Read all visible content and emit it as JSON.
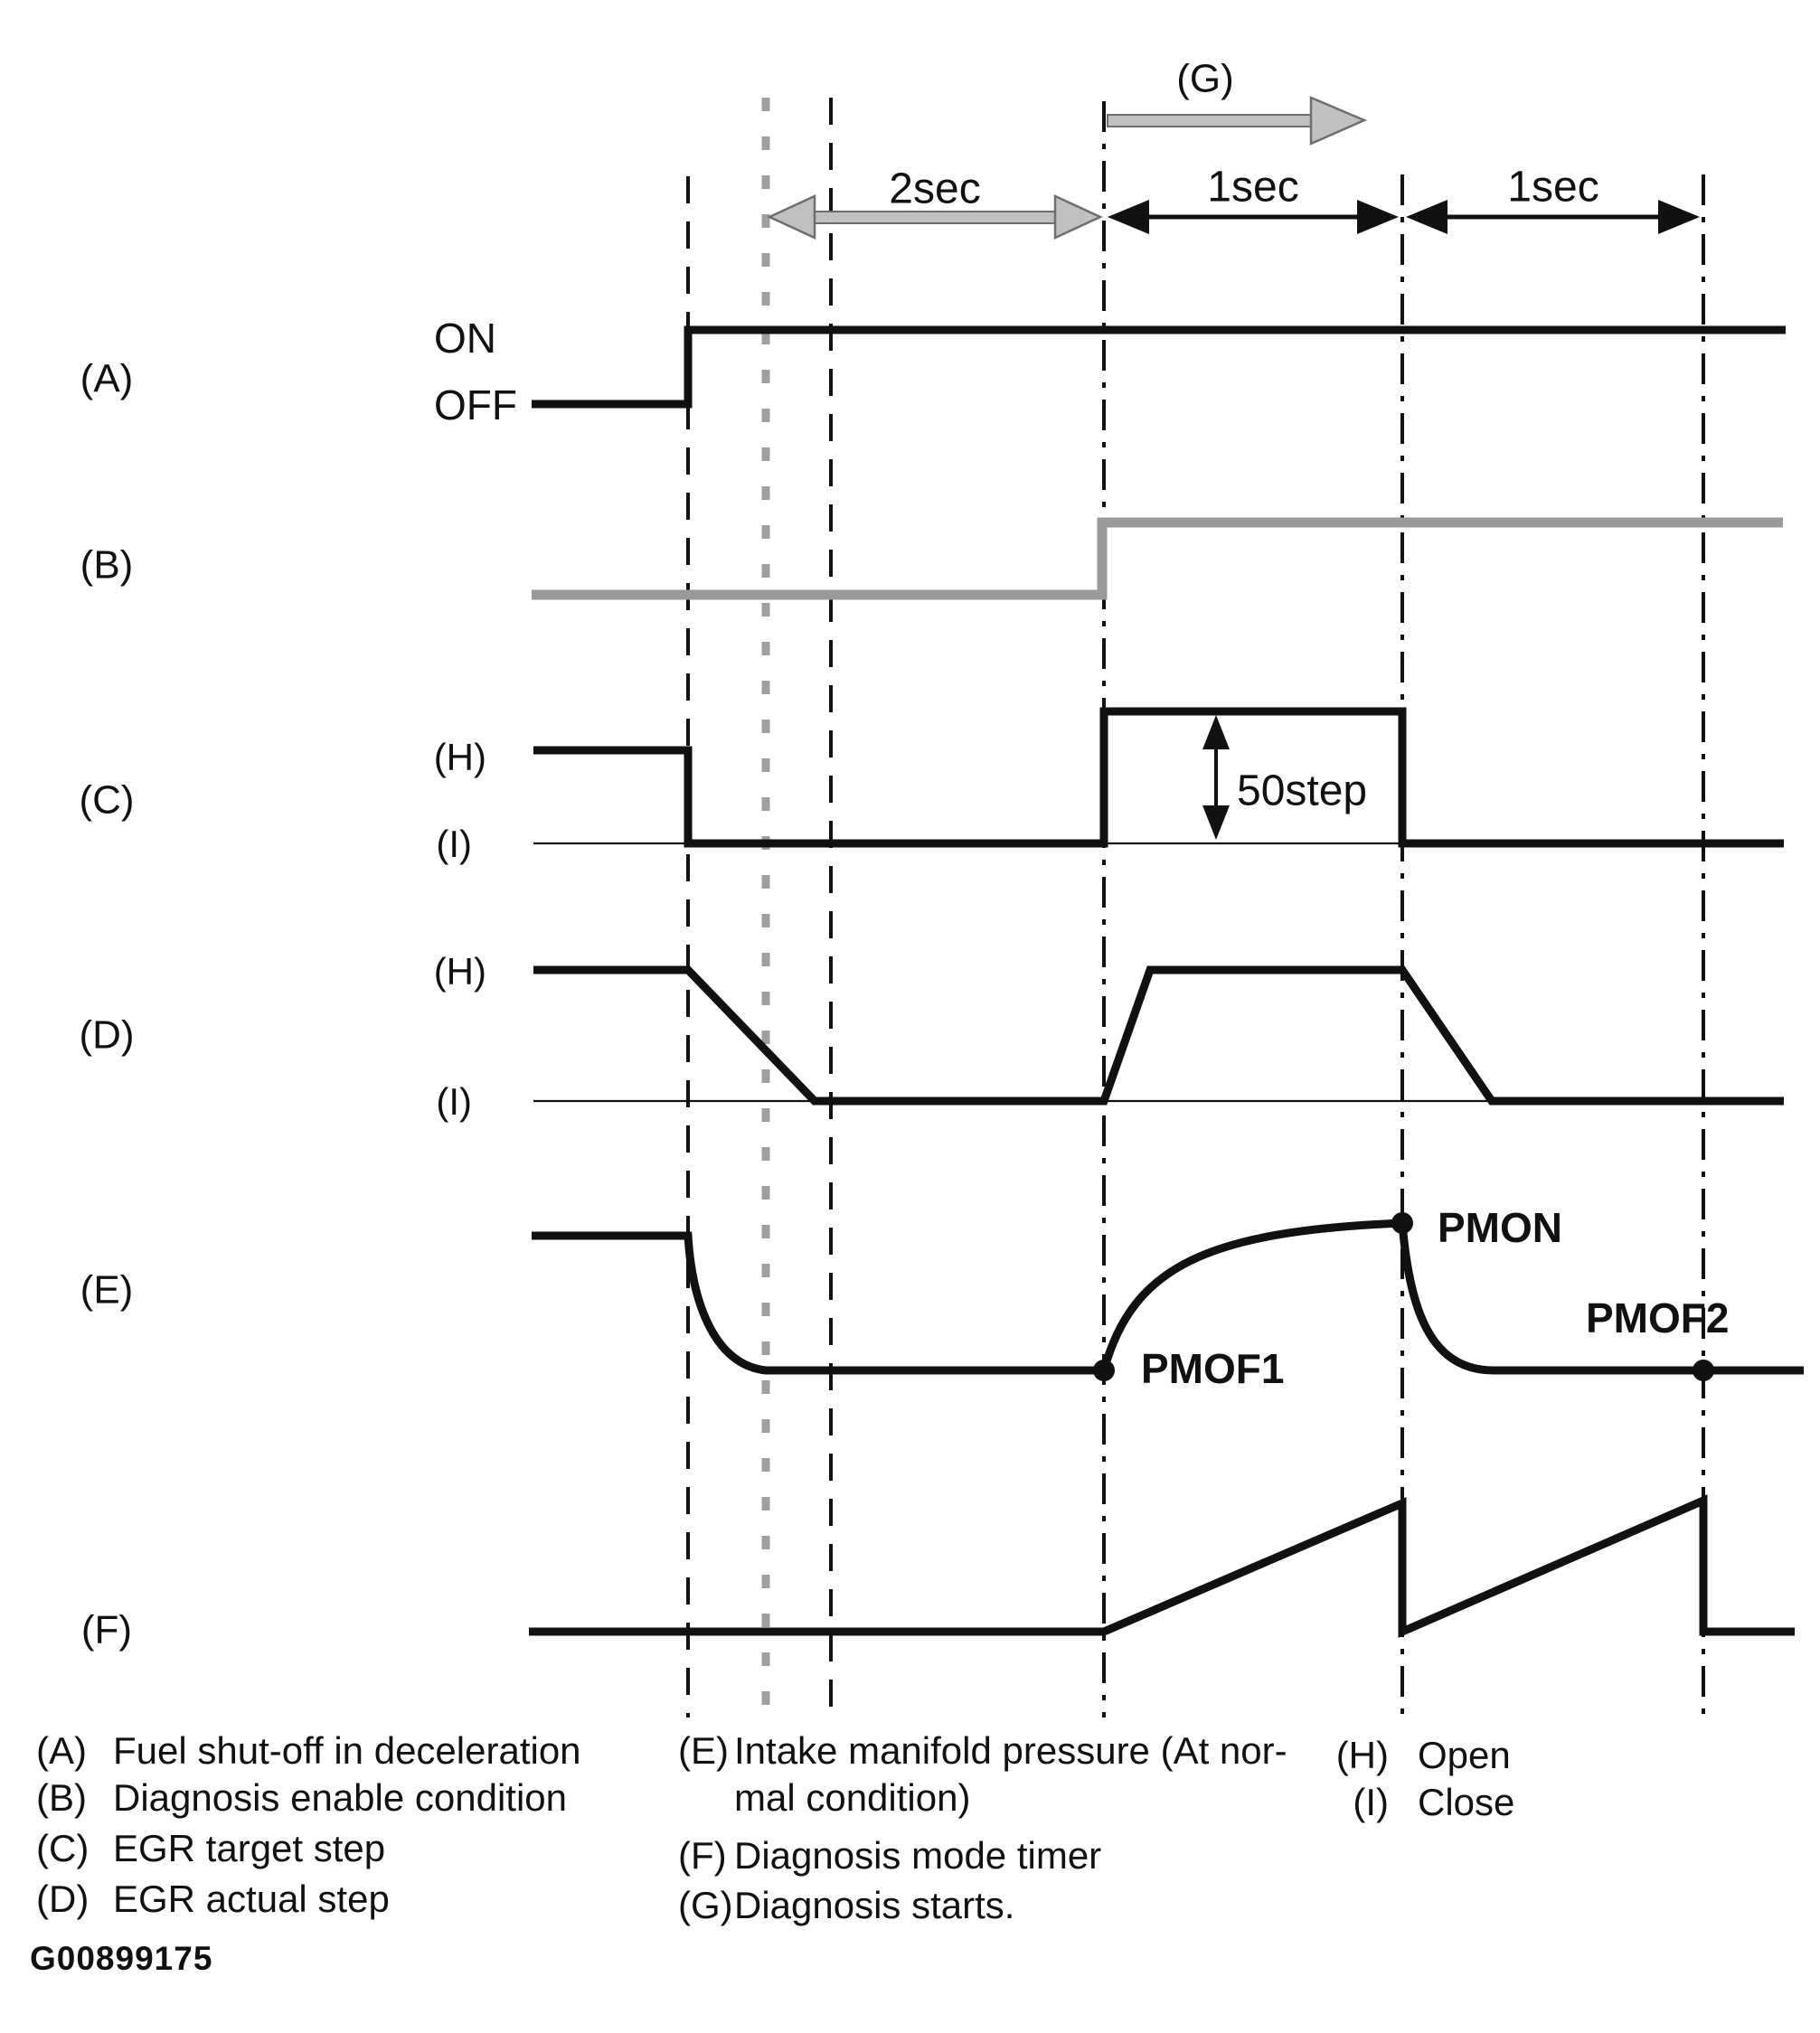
{
  "page": {
    "id_code": "G00899175"
  },
  "timing": {
    "g_label": "(G)",
    "intervals": [
      "2sec",
      "1sec",
      "1sec"
    ],
    "step_label": "50step"
  },
  "signals": {
    "a": {
      "label": "(A)",
      "on": "ON",
      "off": "OFF"
    },
    "b": {
      "label": "(B)"
    },
    "c": {
      "label": "(C)",
      "high": "(H)",
      "low": "(I)"
    },
    "d": {
      "label": "(D)",
      "high": "(H)",
      "low": "(I)"
    },
    "e": {
      "label": "(E)",
      "pmof1": "PMOF1",
      "pmon": "PMON",
      "pmof2": "PMOF2"
    },
    "f": {
      "label": "(F)"
    }
  },
  "legend": {
    "col1": [
      {
        "key": "(A)",
        "text": "Fuel shut-off in deceleration"
      },
      {
        "key": "(B)",
        "text": "Diagnosis enable condition"
      },
      {
        "key": "(C)",
        "text": "EGR target step"
      },
      {
        "key": "(D)",
        "text": "EGR actual step"
      }
    ],
    "col2": [
      {
        "key": "(E)",
        "text": "Intake manifold pressure (At nor-",
        "text2": "mal condition)"
      },
      {
        "key": "(F)",
        "text": "Diagnosis mode timer"
      },
      {
        "key": "(G)",
        "text": "Diagnosis starts."
      }
    ],
    "col3": [
      {
        "key": "(H)",
        "text": "Open"
      },
      {
        "key": "(I)",
        "text": "Close"
      }
    ]
  },
  "colors": {
    "ink": "#111111",
    "signal_gray": "#9a9a9a",
    "arrow_gray": "#c0c0c0",
    "arrow_outline": "#6e6e6e",
    "paper": "#ffffff"
  }
}
